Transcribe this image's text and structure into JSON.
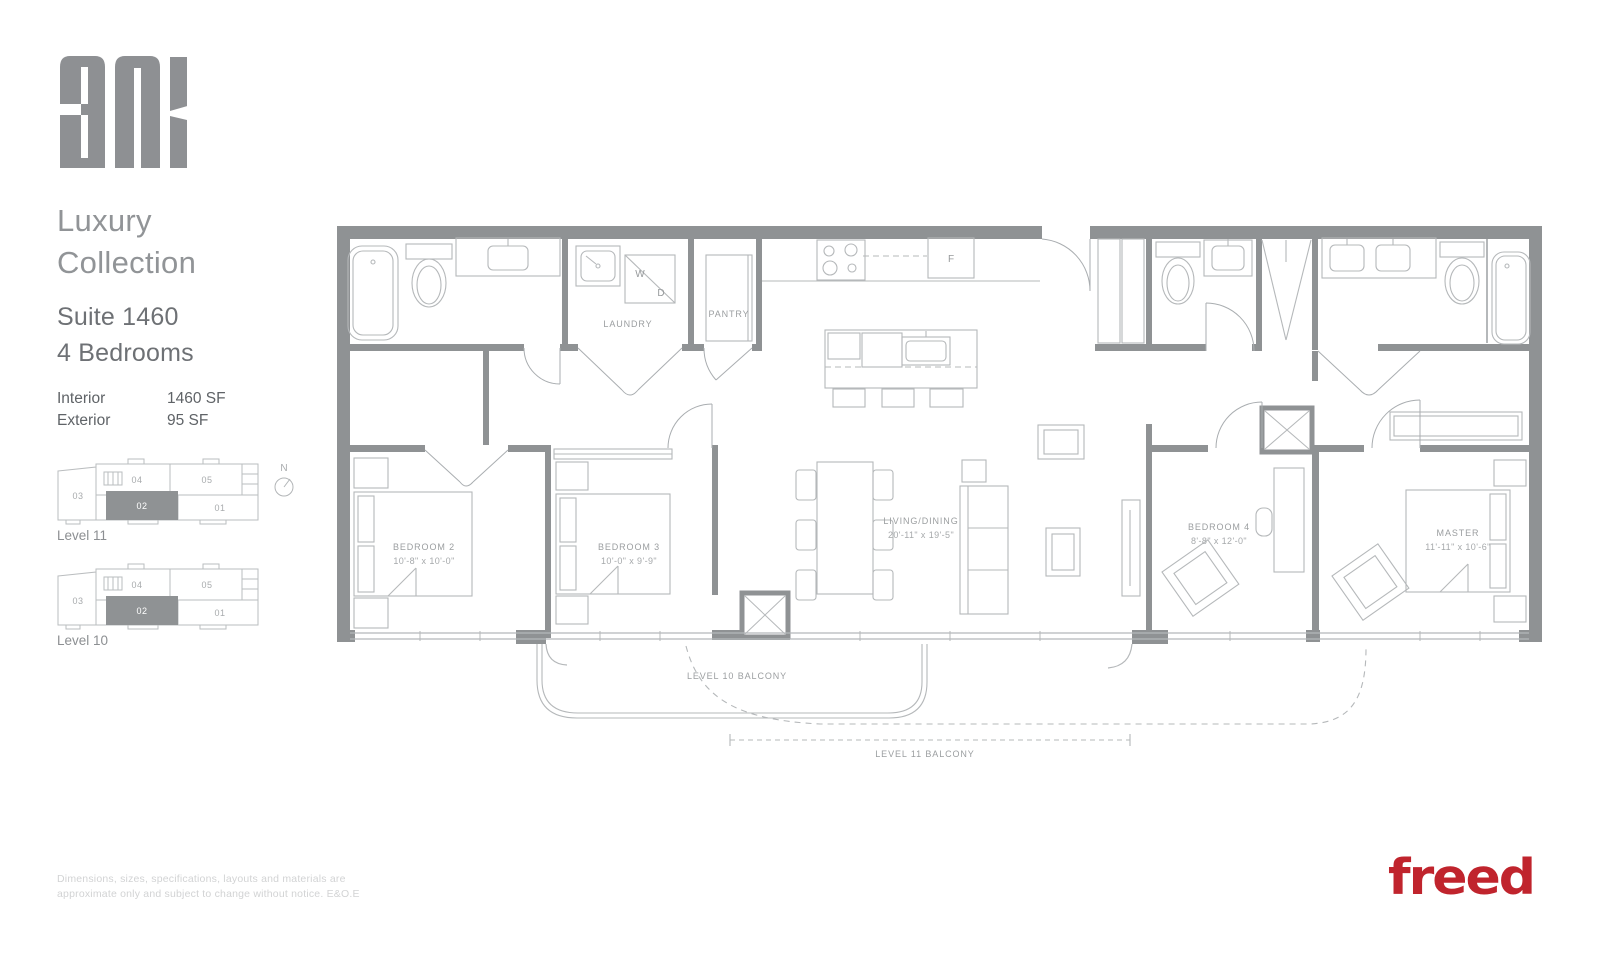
{
  "sidebar": {
    "brand": "anx",
    "collection_title": "Luxury\nCollection",
    "suite_name": "Suite 1460",
    "suite_type": "4 Bedrooms",
    "stats": [
      {
        "label": "Interior",
        "value": "1460 SF"
      },
      {
        "label": "Exterior",
        "value": "95 SF"
      }
    ],
    "keyplans": [
      {
        "level_label": "Level 11",
        "units": [
          "03",
          "04",
          "05",
          "02",
          "01"
        ],
        "highlighted_unit": "02"
      },
      {
        "level_label": "Level 10",
        "units": [
          "03",
          "04",
          "05",
          "02",
          "01"
        ],
        "highlighted_unit": "02"
      }
    ],
    "north_label": "N"
  },
  "plan": {
    "rooms": {
      "laundry": {
        "label": "LAUNDRY"
      },
      "pantry": {
        "label": "PANTRY"
      },
      "bedroom2": {
        "label": "BEDROOM 2",
        "dims": "10'-8\" x 10'-0\""
      },
      "bedroom3": {
        "label": "BEDROOM 3",
        "dims": "10'-0\" x 9'-9\""
      },
      "living": {
        "label": "LIVING/DINING",
        "dims": "20'-11\" x 19'-5\""
      },
      "bedroom4": {
        "label": "BEDROOM 4",
        "dims": "8'-8\" x 12'-0\""
      },
      "master": {
        "label": "MASTER",
        "dims": "11'-11\" x 10'-6\""
      }
    },
    "appliances": {
      "washer": "W",
      "dryer": "D",
      "fridge": "F"
    },
    "balconies": {
      "level10": "LEVEL 10 BALCONY",
      "level11": "LEVEL 11 BALCONY"
    }
  },
  "footer": {
    "disclaimer_line1": "Dimensions, sizes, specifications, layouts and materials are",
    "disclaimer_line2": "approximate only and subject to change without notice. E&O.E",
    "logo": "freed"
  },
  "colors": {
    "wall": "#8f9294",
    "fixture": "#b5b8ba",
    "label": "#9b9ea0",
    "accent_red": "#c0242d"
  }
}
